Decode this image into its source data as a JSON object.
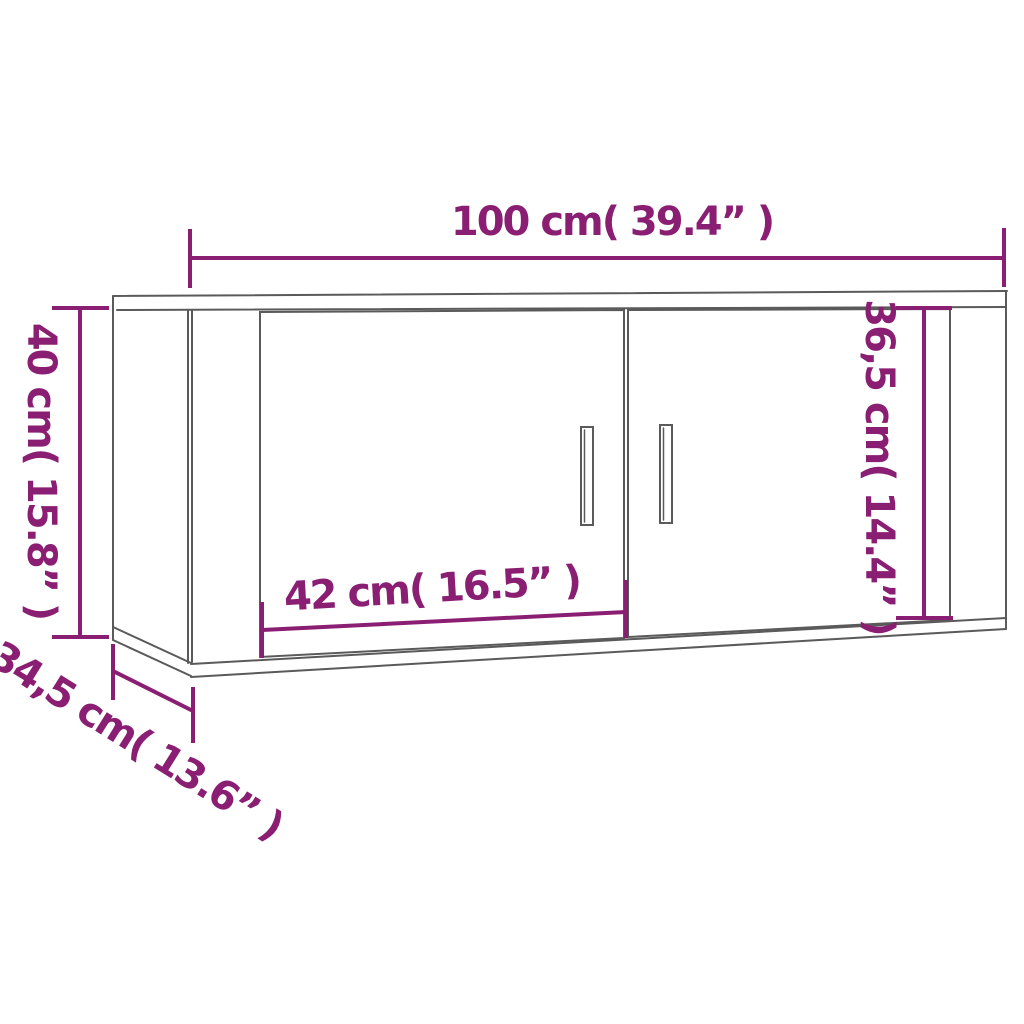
{
  "diagram": {
    "product": "wall-mounted-tv-cabinet",
    "style": "dimension-line-drawing",
    "colors": {
      "dimension_accent": "#8a1e72",
      "outline_gray": "#5a5a5a",
      "background": "#ffffff"
    },
    "dimensions": [
      {
        "id": "overall-width",
        "label": "100 cm( 39.4” )",
        "placement": "top",
        "orientation": "horizontal"
      },
      {
        "id": "overall-height",
        "label": "40 cm( 15.8” )",
        "placement": "left",
        "orientation": "vertical"
      },
      {
        "id": "door-height",
        "label": "36,5 cm( 14.4” )",
        "placement": "right-door",
        "orientation": "vertical"
      },
      {
        "id": "door-width",
        "label": "42 cm( 16.5” )",
        "placement": "left-door-bottom",
        "orientation": "horizontal"
      },
      {
        "id": "overall-depth",
        "label": "34,5 cm( 13.6” )",
        "placement": "bottom-left",
        "orientation": "diagonal"
      }
    ]
  }
}
